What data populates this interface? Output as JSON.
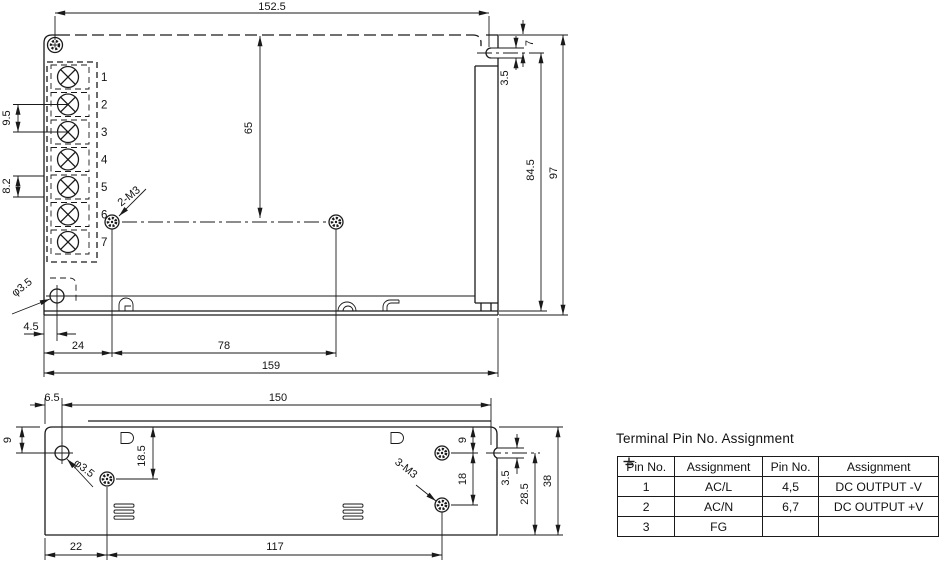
{
  "colors": {
    "line": "#1a1a1a",
    "background": "#ffffff"
  },
  "top_view": {
    "dims": {
      "overall_top": "152.5",
      "terminal_pitch": "9.5",
      "terminal_pitch_b": "8.2",
      "screw_line_from_top": "65",
      "notch_depth": "7",
      "keyhole_offset": "3.5",
      "side_height": "84.5",
      "overall_height": "97",
      "hole_dia": "φ3.5",
      "hole_inset": "4.5",
      "screw_spec": "2-M3",
      "edge_to_screw": "24",
      "screw_span": "78",
      "overall_bottom": "159"
    },
    "terminals": [
      "1",
      "2",
      "3",
      "4",
      "5",
      "6",
      "7"
    ]
  },
  "bottom_view": {
    "dims": {
      "corner_to_hole": "6.5",
      "hole_span": "150",
      "edge_to_hole": "9",
      "hole_dia": "φ3.5",
      "edge_to_screw": "18.5",
      "edge_to_screw_r": "9",
      "screw_pitch": "18",
      "screw_spec": "3-M3",
      "keyhole_offset": "3.5",
      "keyhole_to_bottom": "28.5",
      "overall_depth": "38",
      "edge_to_screw_b": "22",
      "screw_span_b": "117"
    }
  },
  "table": {
    "title": "Terminal Pin No. Assignment",
    "headers": [
      "Pin No.",
      "Assignment",
      "Pin No.",
      "Assignment"
    ],
    "rows": [
      [
        "1",
        "AC/L",
        "4,5",
        "DC OUTPUT -V"
      ],
      [
        "2",
        "AC/N",
        "6,7",
        "DC OUTPUT +V"
      ],
      [
        "3",
        "FG",
        "",
        ""
      ]
    ],
    "ground_icon": "earth-ground-icon"
  }
}
